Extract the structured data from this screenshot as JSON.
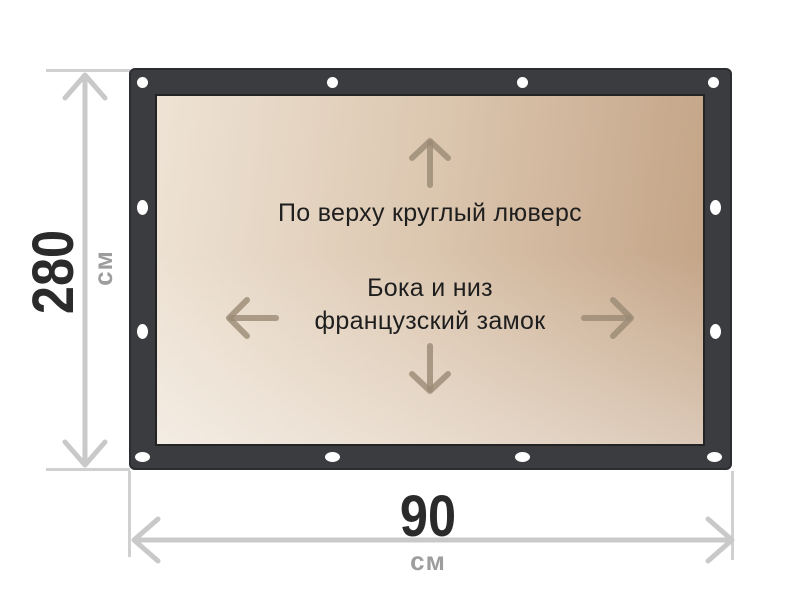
{
  "diagram": {
    "panel": {
      "annotation_top": "По верху круглый люверс",
      "annotation_middle_line1": "Бока и низ",
      "annotation_middle_line2": "французский замок"
    },
    "dimensions": {
      "height": {
        "value": "280",
        "unit": "см"
      },
      "width": {
        "value": "90",
        "unit": "см"
      }
    },
    "icons": {
      "inner_arrows": [
        "arrow-up-icon",
        "arrow-down-icon",
        "arrow-left-icon",
        "arrow-right-icon"
      ],
      "fastener": "grommet-hole"
    },
    "colors": {
      "frame": "#3b3c3f",
      "frame_border": "#2c2d30",
      "panel_light": "#f6efe6",
      "panel_dark": "#c2a284",
      "panel_border": "#242424",
      "grommet": "#ffffff",
      "inner_arrow": "#9a8a74",
      "dimension_line": "#c9c9c9",
      "dimension_value": "#2b2b2b",
      "dimension_unit": "#9d9d9d",
      "annotation_text": "#1e1e1e",
      "background": "#ffffff"
    }
  }
}
